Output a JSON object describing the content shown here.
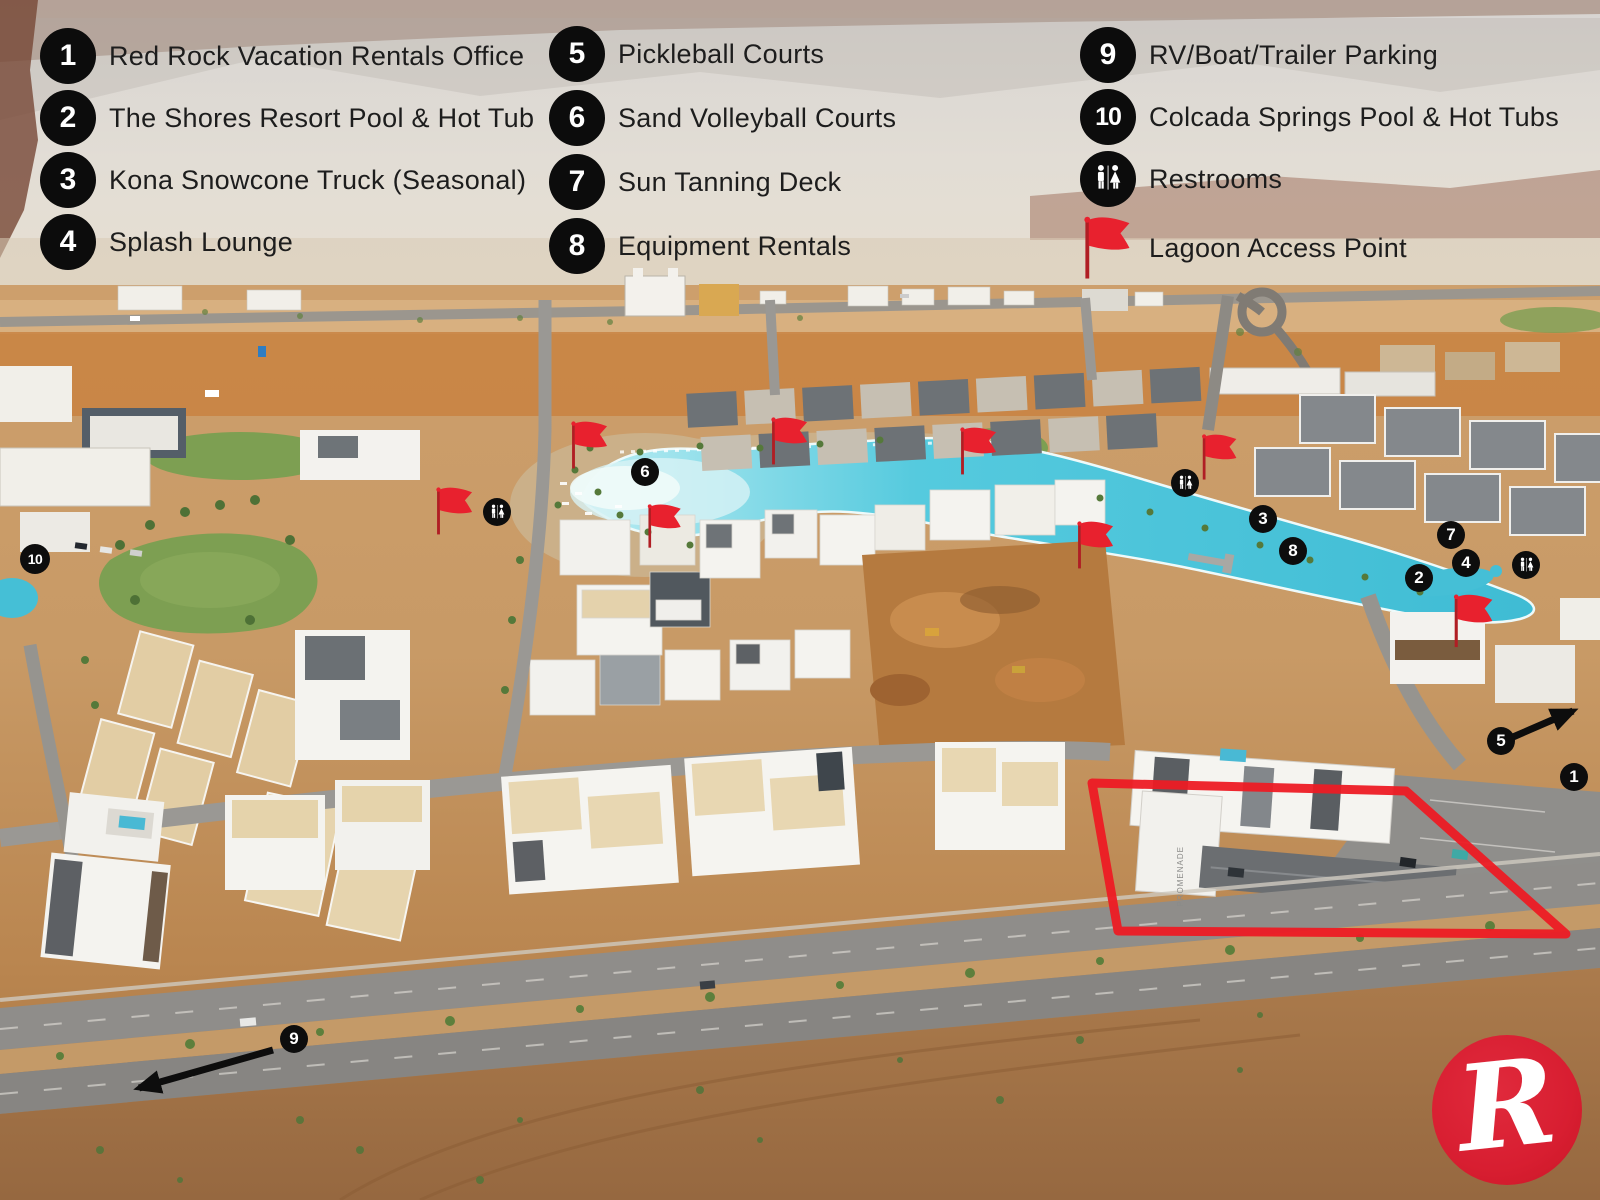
{
  "legend": {
    "col1": [
      {
        "number": "1",
        "label": "Red Rock Vacation Rentals Office"
      },
      {
        "number": "2",
        "label": "The Shores Resort Pool & Hot Tub"
      },
      {
        "number": "3",
        "label": "Kona Snowcone Truck (Seasonal)"
      },
      {
        "number": "4",
        "label": "Splash Lounge"
      }
    ],
    "col2": [
      {
        "number": "5",
        "label": "Pickleball Courts"
      },
      {
        "number": "6",
        "label": "Sand Volleyball Courts"
      },
      {
        "number": "7",
        "label": "Sun Tanning Deck"
      },
      {
        "number": "8",
        "label": "Equipment Rentals"
      }
    ],
    "col3": [
      {
        "number": "9",
        "label": "RV/Boat/Trailer Parking"
      },
      {
        "number": "10",
        "label": "Colcada Springs Pool & Hot Tubs"
      }
    ],
    "restrooms_label": "Restrooms",
    "lagoon_access_label": "Lagoon Access Point"
  },
  "map": {
    "markers": [
      {
        "n": "1"
      },
      {
        "n": "2"
      },
      {
        "n": "3"
      },
      {
        "n": "4"
      },
      {
        "n": "5"
      },
      {
        "n": "6"
      },
      {
        "n": "7"
      },
      {
        "n": "8"
      },
      {
        "n": "9"
      },
      {
        "n": "10"
      }
    ],
    "promenade_label": "PROMENADE",
    "logo_letter": "R"
  },
  "colors": {
    "accent_red": "#e8212e",
    "badge_black": "#0d0d0d",
    "lagoon_water": "#4cc4da",
    "logo_red": "#d81e31"
  }
}
